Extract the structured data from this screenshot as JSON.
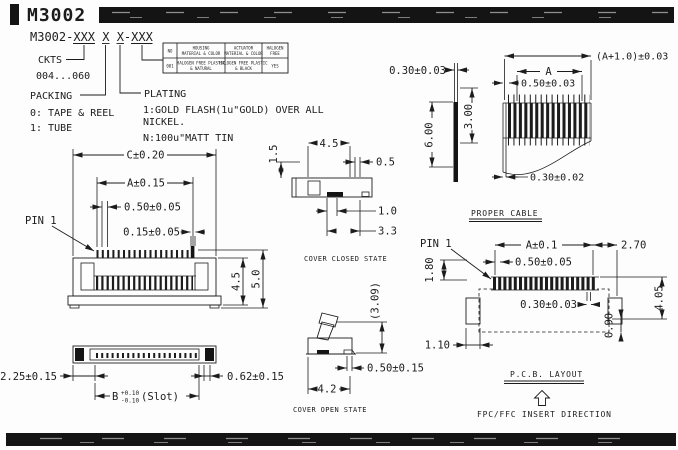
{
  "header": {
    "title": "M3002"
  },
  "ordering": {
    "part_number": "M3002-XXX X X-XXX",
    "ckts_label": "CKTS",
    "ckts_range": "004...060",
    "packing_label": "PACKING",
    "packing_opt1": "0: TAPE & REEL",
    "packing_opt2": "1: TUBE",
    "plating_label": "PLATING",
    "plating_line1": "1:GOLD FLASH(1u\"GOLD) OVER ALL",
    "plating_line2": "NICKEL.",
    "plating_line3": "N:100u\"MATT TIN"
  },
  "materials_table": {
    "col1_header": "NO",
    "housing_header_line1": "HOUSING",
    "housing_header_line2": "MATERIAL & COLOR",
    "actuator_header_line1": "ACTUATOR",
    "actuator_header_line2": "MATERIAL & COLOR",
    "halogen_header_line1": "HALOGEN",
    "halogen_header_line2": "FREE",
    "col1_value": "001",
    "housing_value_line1": "HALOGEN FREE PLASTIC",
    "housing_value_line2": "& NATURAL",
    "actuator_value_line1": "HALOGEN FREE PLASTIC",
    "actuator_value_line2": "& BLACK",
    "halogen_value": "YES"
  },
  "front_view": {
    "pin1": "PIN 1",
    "dim_c": "C±0.20",
    "dim_a": "A±0.15",
    "dim_pitch": "0.50±0.05",
    "dim_pin_width": "0.15±0.05",
    "dim_h_body": "4.5",
    "dim_h_total": "5.0",
    "dim_end_width": "2.25±0.15",
    "dim_tail": "0.62±0.15",
    "slot_b": "B",
    "slot_plus": "+0.10",
    "slot_minus": "-0.10",
    "slot_suffix": "(Slot)"
  },
  "cover_closed": {
    "label": "COVER CLOSED STATE",
    "dim_top": "4.5",
    "dim_left": "1.5",
    "dim_right": "0.5",
    "dim_offset": "1.0",
    "dim_depth": "3.3"
  },
  "cover_open": {
    "label": "COVER OPEN STATE",
    "dim_height": "(3.09)",
    "dim_gap": "0.50±0.15",
    "dim_width": "4.2"
  },
  "cable": {
    "label": "PROPER CABLE",
    "dim_thickness": "0.30±0.03",
    "dim_exposed": "6.00",
    "dim_stiffener": "3.00",
    "dim_overall": "(A+1.0)±0.03",
    "dim_a": "A",
    "dim_pitch": "0.50±0.03",
    "dim_conductor": "0.30±0.02"
  },
  "pcb": {
    "label": "P.C.B. LAYOUT",
    "insert_direction": "FPC/FFC INSERT DIRECTION",
    "pin1": "PIN 1",
    "dim_a": "A±0.1",
    "dim_end": "2.70",
    "dim_pitch": "0.50±0.05",
    "dim_pad_length": "1.80",
    "dim_pad_width": "0.30±0.03",
    "dim_depth": "4.05",
    "dim_090": "0.90",
    "dim_110": "1.10"
  },
  "colors": {
    "line": "#1c1c1c",
    "bar": "#0e0e0e",
    "background": "#fdfdfd"
  }
}
